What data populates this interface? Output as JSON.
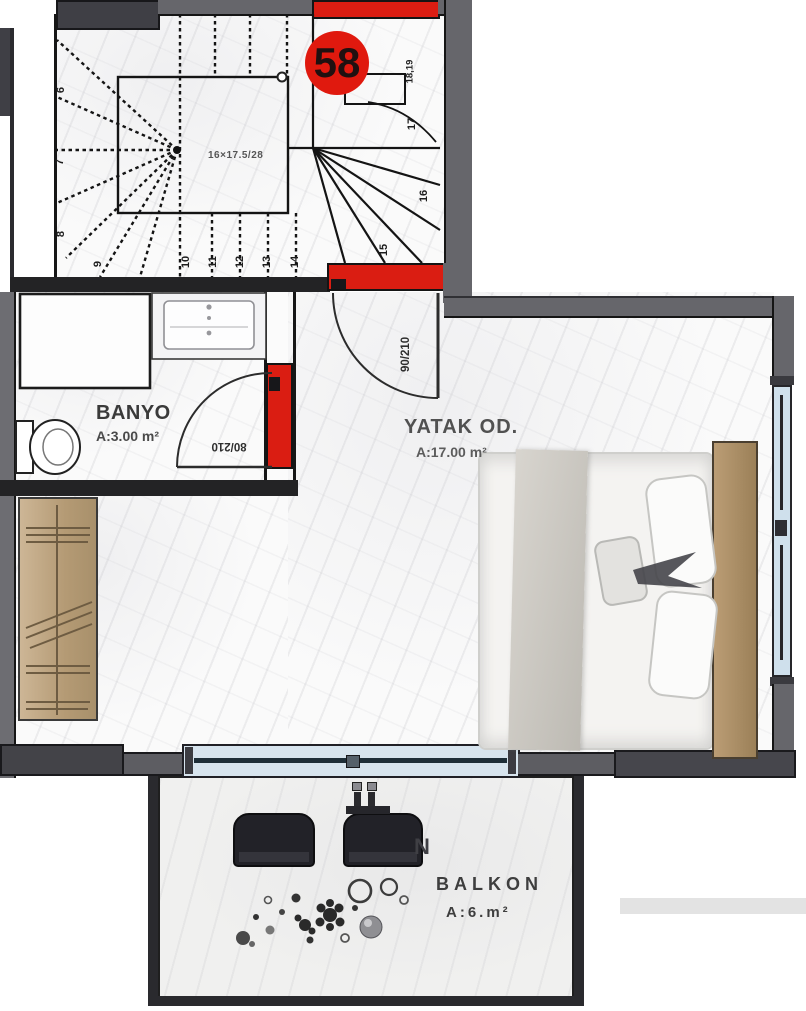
{
  "unit": {
    "number": "58"
  },
  "rooms": {
    "bathroom": {
      "name": "BANYO",
      "area": "A:3.00 m²"
    },
    "bedroom": {
      "name": "YATAK OD.",
      "area": "A:17.00 m²"
    },
    "balcony": {
      "name": "BALKON",
      "area": "A:6.m²",
      "letter": "N"
    }
  },
  "doors": {
    "bathroom": "80/210",
    "bedroom": "90/210"
  },
  "stairs": {
    "notation": "16×17.5/28",
    "numbers": [
      "6",
      "7",
      "8",
      "9",
      "10",
      "11",
      "12",
      "13",
      "14",
      "15",
      "16",
      "17",
      "18,19"
    ]
  },
  "colors": {
    "accent_red": "#da1d12",
    "wall_gray": "#66666b",
    "wall_dark": "#3f3f45",
    "glass_blue": "#cfe0ec",
    "wood": "#b89a72"
  }
}
